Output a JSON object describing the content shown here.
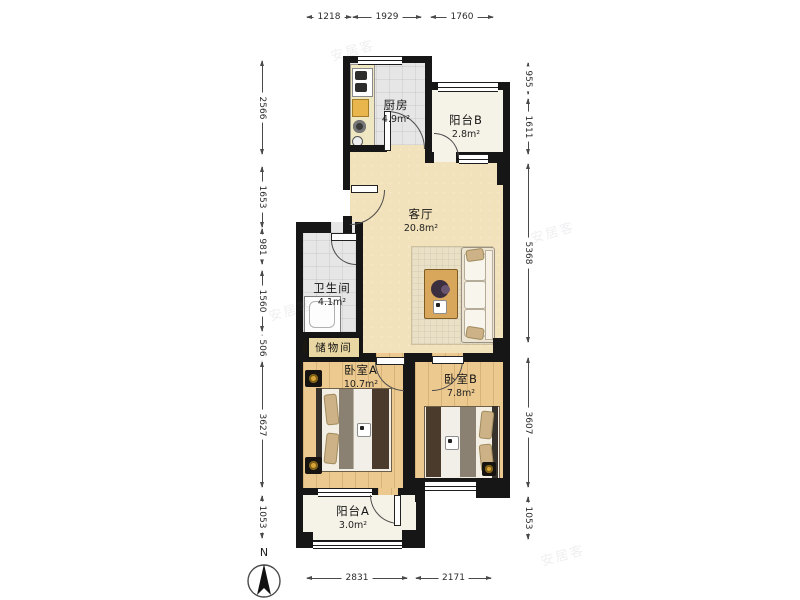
{
  "plan_type": "floorplan",
  "rooms": {
    "kitchen": {
      "name": "厨房",
      "area": "4.9m²"
    },
    "balcony_b": {
      "name": "阳台B",
      "area": "2.8m²"
    },
    "living": {
      "name": "客厅",
      "area": "20.8m²"
    },
    "bathroom": {
      "name": "卫生间",
      "area": "4.1m²"
    },
    "storage": {
      "name": "储物间"
    },
    "bedroom_a": {
      "name": "卧室A",
      "area": "10.7m²"
    },
    "bedroom_b": {
      "name": "卧室B",
      "area": "7.8m²"
    },
    "balcony_a": {
      "name": "阳台A",
      "area": "3.0m²"
    }
  },
  "dimensions": {
    "top": [
      "1218",
      "1929",
      "1760"
    ],
    "left": [
      "2566",
      "1653",
      "981",
      "1560",
      "506",
      "3627",
      "1053"
    ],
    "right": [
      "955",
      "1611",
      "5368",
      "3607",
      "1053"
    ],
    "bottom": [
      "2831",
      "2171"
    ]
  },
  "compass": {
    "label": "N"
  },
  "watermark": {
    "text": "安居客"
  },
  "colors": {
    "wall": "#161616",
    "living_floor": "#f2e2bb",
    "wood_floor": "#ecc98f",
    "tile_floor": "#e6e6e6",
    "balcony_floor": "#f5f2e7",
    "counter_accent": "#e8b64d",
    "storage_plate": "#e9d7a3",
    "lamp_gold": "#d9a437"
  }
}
